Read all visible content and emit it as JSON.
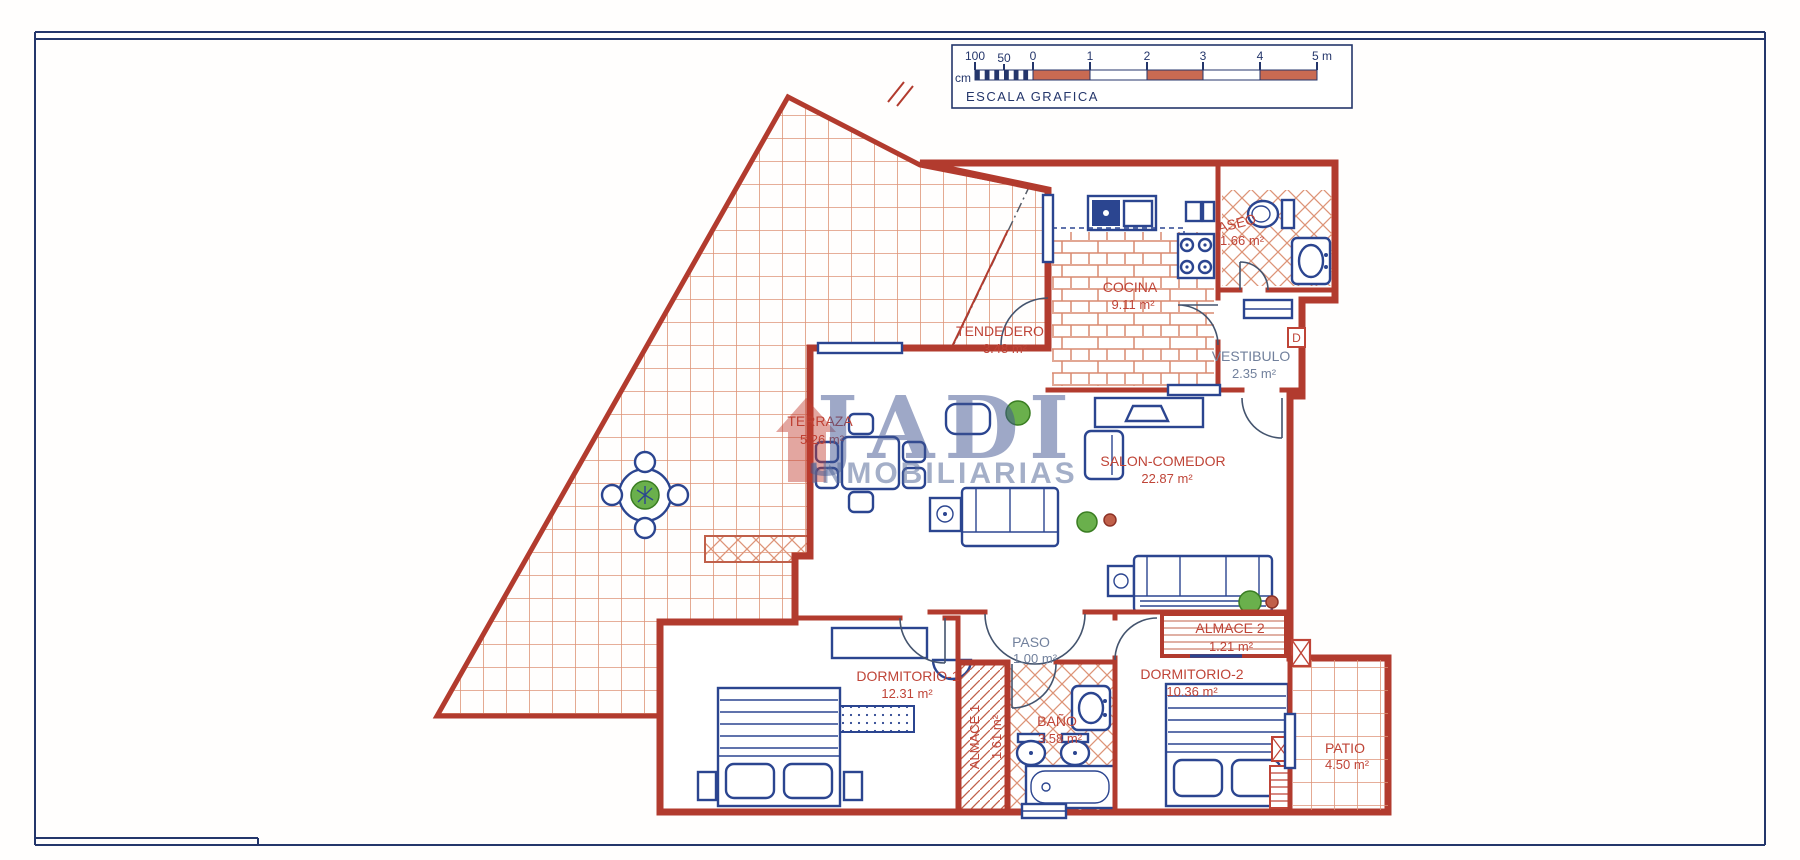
{
  "document": {
    "type": "floor-plan",
    "language": "es"
  },
  "scale_box": {
    "unit_label": "cm",
    "ticks": [
      "100",
      "50",
      "0",
      "1",
      "2",
      "3",
      "4",
      "5 m"
    ],
    "caption": "ESCALA GRAFICA"
  },
  "watermark": {
    "brand": "JADI",
    "subtitle": "INMOBILIARIAS"
  },
  "rooms": [
    {
      "name": "TERRAZA",
      "area": "5.26 m²"
    },
    {
      "name": "TENDEDERO",
      "area": "3.48 m²"
    },
    {
      "name": "COCINA",
      "area": "9.11 m²"
    },
    {
      "name": "ASEO",
      "area": "1.66 m²"
    },
    {
      "name": "VESTIBULO",
      "area": "2.35 m²"
    },
    {
      "name": "SALON-COMEDOR",
      "area": "22.87 m²"
    },
    {
      "name": "PASO",
      "area": "1.00 m²"
    },
    {
      "name": "DORMITORIO-1",
      "area": "12.31 m²"
    },
    {
      "name": "ALMACE 1",
      "area": "1.61 m²"
    },
    {
      "name": "BAÑO",
      "area": "3.58 m²"
    },
    {
      "name": "DORMITORIO-2",
      "area": "10.36 m²"
    },
    {
      "name": "ALMACE 2",
      "area": "1.21 m²"
    },
    {
      "name": "PATIO",
      "area": "4.50 m²"
    }
  ],
  "markers": {
    "electrical_panel": "D"
  },
  "colors": {
    "wall_red": "#b23b2e",
    "fixture_blue": "#2b4590",
    "tile_salmon": "#dd9478",
    "label_red": "#bf4437",
    "label_gray_blue": "#71809c",
    "frame_navy": "#24366b",
    "scale_red": "#c96a52",
    "plant_green": "#6ab04c"
  }
}
